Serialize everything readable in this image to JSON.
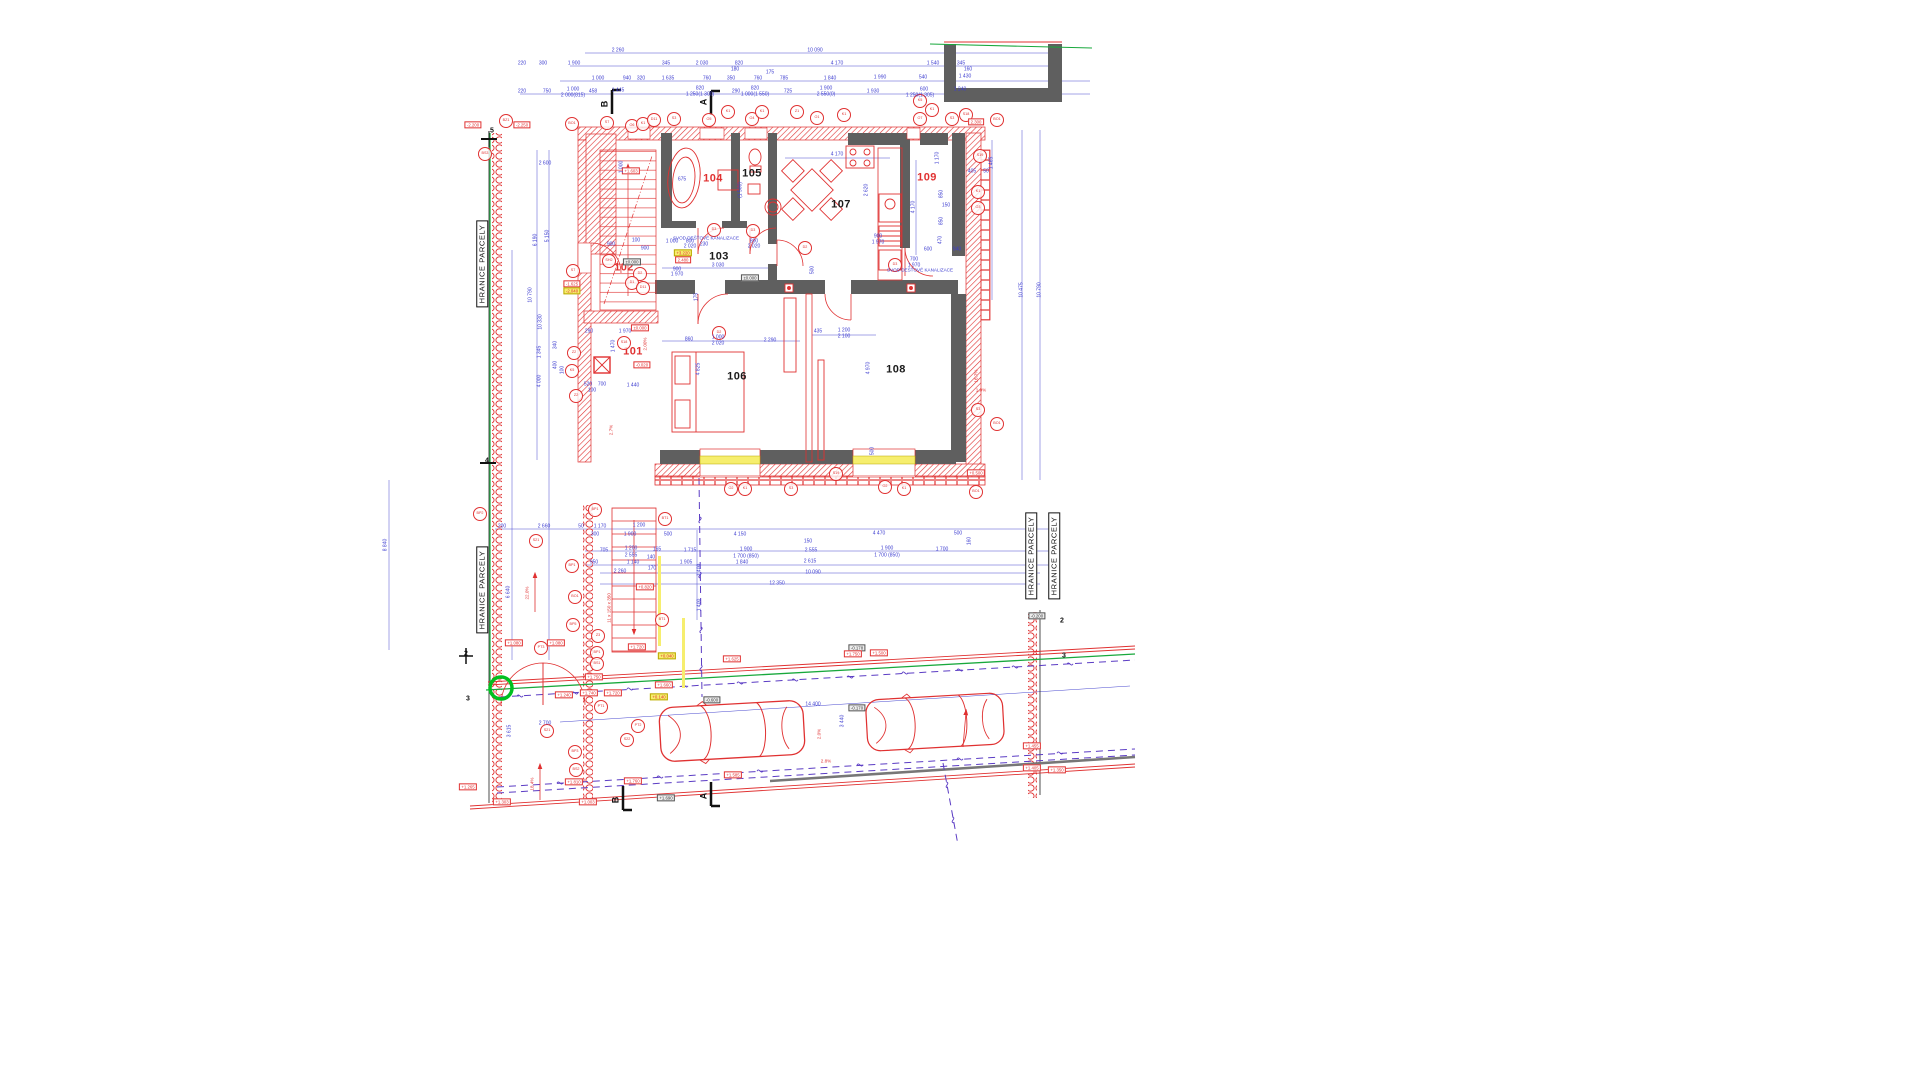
{
  "accent_colors": {
    "wall_red": "#e03131",
    "wall_dark": "#5f5f5f",
    "dim_blue": "#3d3dd0",
    "boundary_green": "#18a83c",
    "utility_purple": "#5b3cc4",
    "window_yellow": "#f6ee6e",
    "highlight_green": "#00c020"
  },
  "boundary": [
    {
      "t": "HRANICE PARCELY",
      "x": 482,
      "y": 264
    },
    {
      "t": "HRANICE PARCELY",
      "x": 482,
      "y": 590
    },
    {
      "t": "HRANICE PARCELY",
      "x": 1031,
      "y": 556
    },
    {
      "t": "HRANICE PARCELY",
      "x": 1054,
      "y": 556
    }
  ],
  "rooms": [
    {
      "t": "101",
      "x": 633,
      "y": 352,
      "s": "r"
    },
    {
      "t": "102",
      "x": 624,
      "y": 268,
      "s": "r"
    },
    {
      "t": "103",
      "x": 719,
      "y": 257
    },
    {
      "t": "104",
      "x": 713,
      "y": 179,
      "s": "r"
    },
    {
      "t": "105",
      "x": 752,
      "y": 174
    },
    {
      "t": "106",
      "x": 737,
      "y": 377
    },
    {
      "t": "107",
      "x": 841,
      "y": 205
    },
    {
      "t": "108",
      "x": 896,
      "y": 370
    },
    {
      "t": "109",
      "x": 927,
      "y": 178,
      "s": "r"
    }
  ],
  "tags": [
    {
      "t": "BZ1",
      "x": 506,
      "y": 121
    },
    {
      "t": "BO1",
      "x": 572,
      "y": 124
    },
    {
      "t": "S7",
      "x": 607,
      "y": 123
    },
    {
      "t": "O6",
      "x": 632,
      "y": 126
    },
    {
      "t": "K1",
      "x": 643,
      "y": 124
    },
    {
      "t": "D11",
      "x": 654,
      "y": 120
    },
    {
      "t": "S3",
      "x": 674,
      "y": 119
    },
    {
      "t": "O5",
      "x": 709,
      "y": 120
    },
    {
      "t": "K1",
      "x": 728,
      "y": 112
    },
    {
      "t": "O4",
      "x": 752,
      "y": 119
    },
    {
      "t": "K1",
      "x": 762,
      "y": 112
    },
    {
      "t": "Z1",
      "x": 797,
      "y": 112
    },
    {
      "t": "O1",
      "x": 817,
      "y": 118
    },
    {
      "t": "K1",
      "x": 844,
      "y": 115
    },
    {
      "t": "K5",
      "x": 920,
      "y": 101
    },
    {
      "t": "K1",
      "x": 932,
      "y": 110
    },
    {
      "t": "O7",
      "x": 920,
      "y": 119
    },
    {
      "t": "S3",
      "x": 952,
      "y": 119
    },
    {
      "t": "S18",
      "x": 966,
      "y": 115
    },
    {
      "t": "BO1",
      "x": 997,
      "y": 120
    },
    {
      "t": "BS3",
      "x": 485,
      "y": 154
    },
    {
      "t": "S7",
      "x": 573,
      "y": 271
    },
    {
      "t": "SH2",
      "x": 609,
      "y": 261
    },
    {
      "t": "D2",
      "x": 640,
      "y": 274
    },
    {
      "t": "D1",
      "x": 632,
      "y": 283
    },
    {
      "t": "D11",
      "x": 643,
      "y": 288
    },
    {
      "t": "S18",
      "x": 624,
      "y": 343
    },
    {
      "t": "Z2",
      "x": 574,
      "y": 353
    },
    {
      "t": "K5",
      "x": 572,
      "y": 371
    },
    {
      "t": "Z2",
      "x": 576,
      "y": 396
    },
    {
      "t": "D3",
      "x": 714,
      "y": 230
    },
    {
      "t": "D3",
      "x": 753,
      "y": 231
    },
    {
      "t": "D3",
      "x": 895,
      "y": 265
    },
    {
      "t": "D2",
      "x": 805,
      "y": 248
    },
    {
      "t": "D2",
      "x": 719,
      "y": 333
    },
    {
      "t": "S19",
      "x": 980,
      "y": 156
    },
    {
      "t": "K1",
      "x": 978,
      "y": 192
    },
    {
      "t": "O3",
      "x": 978,
      "y": 208
    },
    {
      "t": "S3",
      "x": 978,
      "y": 410
    },
    {
      "t": "BO1",
      "x": 997,
      "y": 424
    },
    {
      "t": "S19",
      "x": 836,
      "y": 474
    },
    {
      "t": "O2",
      "x": 885,
      "y": 487
    },
    {
      "t": "K1",
      "x": 904,
      "y": 489
    },
    {
      "t": "BO1",
      "x": 976,
      "y": 492
    },
    {
      "t": "O2",
      "x": 731,
      "y": 489
    },
    {
      "t": "K1",
      "x": 745,
      "y": 489
    },
    {
      "t": "S3",
      "x": 791,
      "y": 489
    },
    {
      "t": "BP2",
      "x": 480,
      "y": 514
    },
    {
      "t": "S21",
      "x": 536,
      "y": 541
    },
    {
      "t": "BP1",
      "x": 595,
      "y": 510
    },
    {
      "t": "BP1",
      "x": 572,
      "y": 566
    },
    {
      "t": "BO1",
      "x": 575,
      "y": 597
    },
    {
      "t": "BP5",
      "x": 573,
      "y": 625
    },
    {
      "t": "Z3",
      "x": 598,
      "y": 636
    },
    {
      "t": "BP1",
      "x": 597,
      "y": 653
    },
    {
      "t": "BS1",
      "x": 597,
      "y": 664
    },
    {
      "t": "BT1",
      "x": 665,
      "y": 519
    },
    {
      "t": "BT1",
      "x": 662,
      "y": 620
    },
    {
      "t": "PT3",
      "x": 541,
      "y": 648
    },
    {
      "t": "PT1",
      "x": 601,
      "y": 707
    },
    {
      "t": "PT2",
      "x": 638,
      "y": 726
    },
    {
      "t": "S21",
      "x": 547,
      "y": 731
    },
    {
      "t": "S22",
      "x": 627,
      "y": 740
    },
    {
      "t": "BP3",
      "x": 575,
      "y": 752
    },
    {
      "t": "BS2",
      "x": 576,
      "y": 770
    }
  ],
  "levels": [
    {
      "t": "-2.200",
      "x": 473,
      "y": 125
    },
    {
      "t": "-2.250",
      "x": 522,
      "y": 125
    },
    {
      "t": "+1.603",
      "x": 631,
      "y": 171
    },
    {
      "t": "-1.625",
      "x": 572,
      "y": 284
    },
    {
      "t": "-2.040",
      "x": 572,
      "y": 291,
      "s": "y"
    },
    {
      "t": "+3.220",
      "x": 683,
      "y": 253,
      "s": "y"
    },
    {
      "t": "2.480",
      "x": 683,
      "y": 260
    },
    {
      "t": "±0.000",
      "x": 632,
      "y": 262,
      "s": "g"
    },
    {
      "t": "±0.000",
      "x": 750,
      "y": 278,
      "s": "g"
    },
    {
      "t": "±0.000",
      "x": 640,
      "y": 328
    },
    {
      "t": "-0.020",
      "x": 642,
      "y": 365
    },
    {
      "t": "2.300",
      "x": 976,
      "y": 122
    },
    {
      "t": "+0.500",
      "x": 976,
      "y": 473
    },
    {
      "t": "+0.820",
      "x": 645,
      "y": 587
    },
    {
      "t": "+1.720",
      "x": 637,
      "y": 647
    },
    {
      "t": "+1.080",
      "x": 514,
      "y": 643
    },
    {
      "t": "+1.080",
      "x": 556,
      "y": 643
    },
    {
      "t": "+1.750",
      "x": 594,
      "y": 677
    },
    {
      "t": "+1.660",
      "x": 664,
      "y": 685
    },
    {
      "t": "+1.625",
      "x": 732,
      "y": 659
    },
    {
      "t": "+1.740",
      "x": 589,
      "y": 693
    },
    {
      "t": "+1.720",
      "x": 613,
      "y": 693
    },
    {
      "t": "+1.240",
      "x": 564,
      "y": 695
    },
    {
      "t": "+0.140",
      "x": 659,
      "y": 697,
      "s": "y"
    },
    {
      "t": "+0.040",
      "x": 667,
      "y": 656,
      "s": "y"
    },
    {
      "t": "-0.600",
      "x": 712,
      "y": 700,
      "s": "g"
    },
    {
      "t": "-0.178",
      "x": 857,
      "y": 648,
      "s": "g"
    },
    {
      "t": "-0.170",
      "x": 857,
      "y": 708,
      "s": "g"
    },
    {
      "t": "+1.810",
      "x": 574,
      "y": 782
    },
    {
      "t": "+1.760",
      "x": 633,
      "y": 781
    },
    {
      "t": "+1.585",
      "x": 733,
      "y": 775
    },
    {
      "t": "+1.690",
      "x": 666,
      "y": 798,
      "s": "g"
    },
    {
      "t": "+1.750",
      "x": 853,
      "y": 654
    },
    {
      "t": "+1.500",
      "x": 879,
      "y": 653
    },
    {
      "t": "+1.455",
      "x": 1032,
      "y": 746
    },
    {
      "t": "+1.405",
      "x": 1032,
      "y": 768
    },
    {
      "t": "+1.350",
      "x": 1057,
      "y": 770
    },
    {
      "t": "-0.200",
      "x": 1037,
      "y": 616,
      "s": "g"
    },
    {
      "t": "+1.265",
      "x": 468,
      "y": 787
    },
    {
      "t": "+1.303",
      "x": 502,
      "y": 802
    },
    {
      "t": "+1.003",
      "x": 588,
      "y": 802
    }
  ],
  "dims": [
    {
      "t": "2 260",
      "x": 618,
      "y": 51
    },
    {
      "t": "10 090",
      "x": 815,
      "y": 51
    },
    {
      "t": "220",
      "x": 522,
      "y": 64
    },
    {
      "t": "300",
      "x": 543,
      "y": 64
    },
    {
      "t": "1 900",
      "x": 574,
      "y": 64
    },
    {
      "t": "345",
      "x": 666,
      "y": 64
    },
    {
      "t": "2 030",
      "x": 702,
      "y": 64
    },
    {
      "t": "820",
      "x": 739,
      "y": 64
    },
    {
      "t": "180",
      "x": 735,
      "y": 70
    },
    {
      "t": "4 170",
      "x": 837,
      "y": 64
    },
    {
      "t": "175",
      "x": 770,
      "y": 73
    },
    {
      "t": "1 540",
      "x": 933,
      "y": 64
    },
    {
      "t": "345",
      "x": 961,
      "y": 64
    },
    {
      "t": "160",
      "x": 968,
      "y": 70
    },
    {
      "t": "1 000",
      "x": 598,
      "y": 79
    },
    {
      "t": "940",
      "x": 627,
      "y": 79
    },
    {
      "t": "320",
      "x": 641,
      "y": 79
    },
    {
      "t": "1 635",
      "x": 668,
      "y": 79
    },
    {
      "t": "760",
      "x": 707,
      "y": 79
    },
    {
      "t": "350",
      "x": 731,
      "y": 79
    },
    {
      "t": "760",
      "x": 758,
      "y": 79
    },
    {
      "t": "785",
      "x": 784,
      "y": 79
    },
    {
      "t": "1 840",
      "x": 830,
      "y": 79
    },
    {
      "t": "1 990",
      "x": 880,
      "y": 78
    },
    {
      "t": "540",
      "x": 923,
      "y": 78
    },
    {
      "t": "1 430",
      "x": 965,
      "y": 77
    },
    {
      "t": "220",
      "x": 522,
      "y": 92
    },
    {
      "t": "750",
      "x": 547,
      "y": 92
    },
    {
      "t": "1 000",
      "x": 573,
      "y": 90
    },
    {
      "t": "2 000(815)",
      "x": 573,
      "y": 96
    },
    {
      "t": "458",
      "x": 593,
      "y": 92
    },
    {
      "t": "1 445",
      "x": 618,
      "y": 91
    },
    {
      "t": "820",
      "x": 700,
      "y": 89
    },
    {
      "t": "1 250(1 300)",
      "x": 700,
      "y": 95
    },
    {
      "t": "290",
      "x": 736,
      "y": 92
    },
    {
      "t": "820",
      "x": 755,
      "y": 89
    },
    {
      "t": "1 000(1 550)",
      "x": 755,
      "y": 95
    },
    {
      "t": "725",
      "x": 788,
      "y": 92
    },
    {
      "t": "1 900",
      "x": 826,
      "y": 89
    },
    {
      "t": "2 550(0)",
      "x": 826,
      "y": 95
    },
    {
      "t": "1 930",
      "x": 873,
      "y": 92
    },
    {
      "t": "600",
      "x": 924,
      "y": 90
    },
    {
      "t": "1 240",
      "x": 960,
      "y": 90
    },
    {
      "t": "1 250(1 305)",
      "x": 920,
      "y": 96
    },
    {
      "t": "2 600",
      "x": 545,
      "y": 164
    },
    {
      "t": "6 190",
      "x": 536,
      "y": 240,
      "r": 1
    },
    {
      "t": "5 150",
      "x": 548,
      "y": 236,
      "r": 1
    },
    {
      "t": "10 790",
      "x": 531,
      "y": 295,
      "r": 1
    },
    {
      "t": "10 330",
      "x": 541,
      "y": 322,
      "r": 1
    },
    {
      "t": "1 345",
      "x": 540,
      "y": 352,
      "r": 1
    },
    {
      "t": "340",
      "x": 556,
      "y": 345,
      "r": 1
    },
    {
      "t": "400",
      "x": 556,
      "y": 365,
      "r": 1
    },
    {
      "t": "100",
      "x": 563,
      "y": 370,
      "r": 1
    },
    {
      "t": "4 000",
      "x": 540,
      "y": 381,
      "r": 1
    },
    {
      "t": "8 840",
      "x": 386,
      "y": 545,
      "r": 1
    },
    {
      "t": "6 640",
      "x": 509,
      "y": 592,
      "r": 1
    },
    {
      "t": "200",
      "x": 502,
      "y": 527
    },
    {
      "t": "2 660",
      "x": 544,
      "y": 527
    },
    {
      "t": "50",
      "x": 581,
      "y": 527
    },
    {
      "t": "1 170",
      "x": 600,
      "y": 527
    },
    {
      "t": "1 200",
      "x": 639,
      "y": 526
    },
    {
      "t": "300",
      "x": 595,
      "y": 535
    },
    {
      "t": "1 900",
      "x": 630,
      "y": 535
    },
    {
      "t": "500",
      "x": 668,
      "y": 535
    },
    {
      "t": "1 000",
      "x": 622,
      "y": 167,
      "r": 1
    },
    {
      "t": "900",
      "x": 611,
      "y": 245
    },
    {
      "t": "100",
      "x": 636,
      "y": 241
    },
    {
      "t": "900",
      "x": 645,
      "y": 249
    },
    {
      "t": "1 970",
      "x": 625,
      "y": 332
    },
    {
      "t": "290",
      "x": 589,
      "y": 332
    },
    {
      "t": "1 470",
      "x": 614,
      "y": 346,
      "r": 1
    },
    {
      "t": "1 440",
      "x": 633,
      "y": 386
    },
    {
      "t": "520",
      "x": 588,
      "y": 385
    },
    {
      "t": "700",
      "x": 602,
      "y": 385
    },
    {
      "t": "100",
      "x": 592,
      "y": 391
    },
    {
      "t": "675",
      "x": 682,
      "y": 180
    },
    {
      "t": "(1 500)",
      "x": 741,
      "y": 190,
      "r": 1
    },
    {
      "t": "3 030",
      "x": 718,
      "y": 266
    },
    {
      "t": "900",
      "x": 677,
      "y": 270
    },
    {
      "t": "1 970",
      "x": 677,
      "y": 275
    },
    {
      "t": "1 000",
      "x": 672,
      "y": 242
    },
    {
      "t": "800",
      "x": 690,
      "y": 242
    },
    {
      "t": "2 020",
      "x": 690,
      "y": 247
    },
    {
      "t": "230",
      "x": 704,
      "y": 245
    },
    {
      "t": "800",
      "x": 754,
      "y": 242
    },
    {
      "t": "2 020",
      "x": 754,
      "y": 247
    },
    {
      "t": "4 170",
      "x": 837,
      "y": 155
    },
    {
      "t": "2 620",
      "x": 867,
      "y": 190,
      "r": 1
    },
    {
      "t": "4 170",
      "x": 914,
      "y": 207,
      "r": 1
    },
    {
      "t": "900",
      "x": 878,
      "y": 237
    },
    {
      "t": "1 970",
      "x": 878,
      "y": 243
    },
    {
      "t": "700",
      "x": 914,
      "y": 260
    },
    {
      "t": "1 970",
      "x": 914,
      "y": 266
    },
    {
      "t": "860",
      "x": 689,
      "y": 340
    },
    {
      "t": "1 000",
      "x": 718,
      "y": 338
    },
    {
      "t": "2 020",
      "x": 718,
      "y": 344
    },
    {
      "t": "2 290",
      "x": 770,
      "y": 341
    },
    {
      "t": "4 825",
      "x": 699,
      "y": 369,
      "r": 1
    },
    {
      "t": "435",
      "x": 818,
      "y": 332
    },
    {
      "t": "1 200",
      "x": 844,
      "y": 331
    },
    {
      "t": "2 100",
      "x": 844,
      "y": 337
    },
    {
      "t": "500",
      "x": 813,
      "y": 270,
      "r": 1
    },
    {
      "t": "175",
      "x": 697,
      "y": 297,
      "r": 1
    },
    {
      "t": "4 970",
      "x": 869,
      "y": 368,
      "r": 1
    },
    {
      "t": "500",
      "x": 873,
      "y": 451,
      "r": 1
    },
    {
      "t": "1 465",
      "x": 992,
      "y": 163,
      "r": 1
    },
    {
      "t": "405",
      "x": 972,
      "y": 172
    },
    {
      "t": "50",
      "x": 986,
      "y": 172
    },
    {
      "t": "1 170",
      "x": 938,
      "y": 158,
      "r": 1
    },
    {
      "t": "850",
      "x": 942,
      "y": 194,
      "r": 1
    },
    {
      "t": "150",
      "x": 946,
      "y": 206
    },
    {
      "t": "850",
      "x": 942,
      "y": 221,
      "r": 1
    },
    {
      "t": "470",
      "x": 941,
      "y": 240,
      "r": 1
    },
    {
      "t": "940",
      "x": 957,
      "y": 250
    },
    {
      "t": "600",
      "x": 928,
      "y": 250
    },
    {
      "t": "10 475",
      "x": 1022,
      "y": 290,
      "r": 1
    },
    {
      "t": "10 790",
      "x": 1040,
      "y": 290,
      "r": 1
    },
    {
      "t": "4 470",
      "x": 879,
      "y": 534
    },
    {
      "t": "500",
      "x": 958,
      "y": 534
    },
    {
      "t": "160",
      "x": 970,
      "y": 541,
      "r": 1
    },
    {
      "t": "1 900",
      "x": 887,
      "y": 549
    },
    {
      "t": "1 700 (850)",
      "x": 887,
      "y": 556
    },
    {
      "t": "1 700",
      "x": 942,
      "y": 550
    },
    {
      "t": "4 150",
      "x": 740,
      "y": 535
    },
    {
      "t": "150",
      "x": 808,
      "y": 542
    },
    {
      "t": "705",
      "x": 604,
      "y": 551
    },
    {
      "t": "1 200",
      "x": 631,
      "y": 549
    },
    {
      "t": "2 555",
      "x": 631,
      "y": 556
    },
    {
      "t": "165",
      "x": 657,
      "y": 550
    },
    {
      "t": "1 715",
      "x": 690,
      "y": 551
    },
    {
      "t": "1 900",
      "x": 746,
      "y": 550
    },
    {
      "t": "1 700 (850)",
      "x": 746,
      "y": 557
    },
    {
      "t": "2 555",
      "x": 811,
      "y": 551
    },
    {
      "t": "950",
      "x": 594,
      "y": 563
    },
    {
      "t": "1 140",
      "x": 633,
      "y": 563
    },
    {
      "t": "140",
      "x": 651,
      "y": 558
    },
    {
      "t": "1 905",
      "x": 686,
      "y": 563
    },
    {
      "t": "1 840",
      "x": 742,
      "y": 563
    },
    {
      "t": "2 615",
      "x": 810,
      "y": 562
    },
    {
      "t": "2 260",
      "x": 620,
      "y": 572
    },
    {
      "t": "170",
      "x": 652,
      "y": 569
    },
    {
      "t": "10 090",
      "x": 813,
      "y": 573
    },
    {
      "t": "12 350",
      "x": 777,
      "y": 584
    },
    {
      "t": "1 400",
      "x": 700,
      "y": 570,
      "r": 1
    },
    {
      "t": "1 400",
      "x": 700,
      "y": 605,
      "r": 1
    },
    {
      "t": "14 400",
      "x": 813,
      "y": 705
    },
    {
      "t": "2 700",
      "x": 545,
      "y": 724
    },
    {
      "t": "3 615",
      "x": 510,
      "y": 731,
      "r": 1
    },
    {
      "t": "3 440",
      "x": 843,
      "y": 721,
      "r": 1
    }
  ],
  "notes": [
    {
      "t": "SVOD DEŠŤOVÉ KANALIZACE",
      "x": 706,
      "y": 239
    },
    {
      "t": "SVOD DEŠŤOVÉ KANALIZACE",
      "x": 920,
      "y": 271
    },
    {
      "t": "22.0%",
      "x": 528,
      "y": 593,
      "r": 1,
      "s": "r"
    },
    {
      "t": "18.4%",
      "x": 533,
      "y": 784,
      "r": 1,
      "s": "r"
    },
    {
      "t": "2.0%",
      "x": 820,
      "y": 734,
      "r": 1,
      "s": "r"
    },
    {
      "t": "2.8%",
      "x": 826,
      "y": 762,
      "s": "r"
    },
    {
      "t": "1.0%",
      "x": 981,
      "y": 391,
      "s": "r"
    },
    {
      "t": "2.00%",
      "x": 646,
      "y": 344,
      "r": 1,
      "s": "r"
    },
    {
      "t": "16.7%",
      "x": 977,
      "y": 376,
      "r": 1,
      "s": "r"
    },
    {
      "t": "2.7%",
      "x": 612,
      "y": 430,
      "r": 1,
      "s": "r"
    },
    {
      "t": "11 x 150 x 350",
      "x": 610,
      "y": 608,
      "r": 1,
      "s": "r"
    }
  ],
  "grids": [
    {
      "t": "5",
      "x": 492,
      "y": 131
    },
    {
      "t": "4",
      "x": 487,
      "y": 461
    },
    {
      "t": "2",
      "x": 466,
      "y": 654
    },
    {
      "t": "3",
      "x": 468,
      "y": 699
    },
    {
      "t": "2",
      "x": 1062,
      "y": 621
    },
    {
      "t": "3",
      "x": 1064,
      "y": 656
    }
  ],
  "sections": [
    {
      "t": "B",
      "x": 605,
      "y": 104
    },
    {
      "t": "A",
      "x": 704,
      "y": 102
    },
    {
      "t": "B",
      "x": 616,
      "y": 800
    },
    {
      "t": "A",
      "x": 704,
      "y": 796
    }
  ]
}
